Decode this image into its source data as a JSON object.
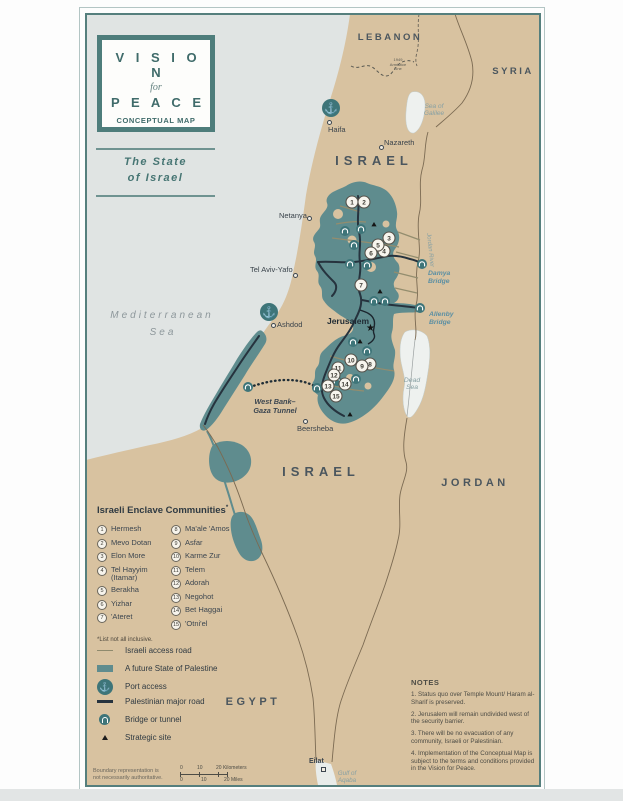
{
  "colors": {
    "land": "#d8c2a0",
    "sea": "#e0e4e3",
    "palestine": "#5f8c8e",
    "lake": "#eef1ef",
    "frame": "#557f7d",
    "teal_icon": "#3e7579",
    "road_dark": "#26333e",
    "road_access": "#938d6e",
    "border_line": "#7b6a52",
    "title_teal": "#3f6b6a"
  },
  "title_box": {
    "line1": "V I S I O N",
    "line2": "for",
    "line3": "P E A C E",
    "line4": "CONCEPTUAL MAP"
  },
  "subtitle": {
    "line1": "The State",
    "line2": "of Israel"
  },
  "countries": {
    "lebanon": "LEBANON",
    "syria": "SYRIA",
    "israel_north": "ISRAEL",
    "israel_south": "ISRAEL",
    "jordan": "JORDAN",
    "egypt": "EGYPT"
  },
  "water": {
    "med1": "Mediterranean",
    "med2": "Sea",
    "galilee1": "Sea of",
    "galilee2": "Galilee",
    "dead1": "Dead",
    "dead2": "Sea",
    "gulf1": "Gulf of",
    "gulf2": "Aqaba",
    "jordan_river": "Jordan River"
  },
  "cities": {
    "haifa": "Haifa",
    "nazareth": "Nazareth",
    "netanya": "Netanya",
    "tel_aviv": "Tel Aviv-Yafo",
    "ashdod": "Ashdod",
    "jerusalem": "Jerusalem",
    "beersheba": "Beersheba",
    "eilat": "Eilat"
  },
  "map_labels": {
    "damya1": "Damya",
    "damya2": "Bridge",
    "allenby1": "Allenby",
    "allenby2": "Bridge",
    "tunnel1": "West Bank–",
    "tunnel2": "Gaza Tunnel",
    "armistice1": "1949",
    "armistice2": "Armistice",
    "armistice3": "Line"
  },
  "enclave_legend": {
    "title": "Israeli Enclave Communities",
    "asterisk": "*",
    "footnote": "*List not all inclusive."
  },
  "enclaves": [
    {
      "num": "1",
      "name": "Hermesh"
    },
    {
      "num": "2",
      "name": "Mevo Dotan"
    },
    {
      "num": "3",
      "name": "Elon More"
    },
    {
      "num": "4",
      "name": "Tel Hayyim (Itamar)"
    },
    {
      "num": "5",
      "name": "Berakha"
    },
    {
      "num": "6",
      "name": "Yizhar"
    },
    {
      "num": "7",
      "name": "'Ateret"
    },
    {
      "num": "8",
      "name": "Ma'ale 'Amos"
    },
    {
      "num": "9",
      "name": "Asfar"
    },
    {
      "num": "10",
      "name": "Karme Zur"
    },
    {
      "num": "11",
      "name": "Telem"
    },
    {
      "num": "12",
      "name": "Adorah"
    },
    {
      "num": "13",
      "name": "Negohot"
    },
    {
      "num": "14",
      "name": "Bet Haggai"
    },
    {
      "num": "15",
      "name": "'Otni'el"
    }
  ],
  "map_legend": {
    "items": [
      {
        "label": "Israeli access road"
      },
      {
        "label": "A future State of Palestine"
      },
      {
        "label": "Port access"
      },
      {
        "label": "Palestinian major road"
      },
      {
        "label": "Bridge or tunnel"
      },
      {
        "label": "Strategic site"
      }
    ]
  },
  "port_glyph": "⚓",
  "scale": {
    "km0": "0",
    "km10": "10",
    "km20": "20 Kilometers",
    "mi0": "0",
    "mi10": "10",
    "mi20": "20 Miles"
  },
  "disclaimer": {
    "line1": "Boundary representation is",
    "line2": "not necessarily authoritative."
  },
  "notes": {
    "title": "NOTES",
    "items": [
      "1. Status quo over Temple Mount/ Haram al-Sharif is preserved.",
      "2. Jerusalem will remain undivided west of the security barrier.",
      "3. There will be no evacuation of any community, Israeli or Palestinian.",
      "4. Implementation of the Conceptual Map is subject to the terms and conditions provided in the Vision for Peace."
    ]
  }
}
